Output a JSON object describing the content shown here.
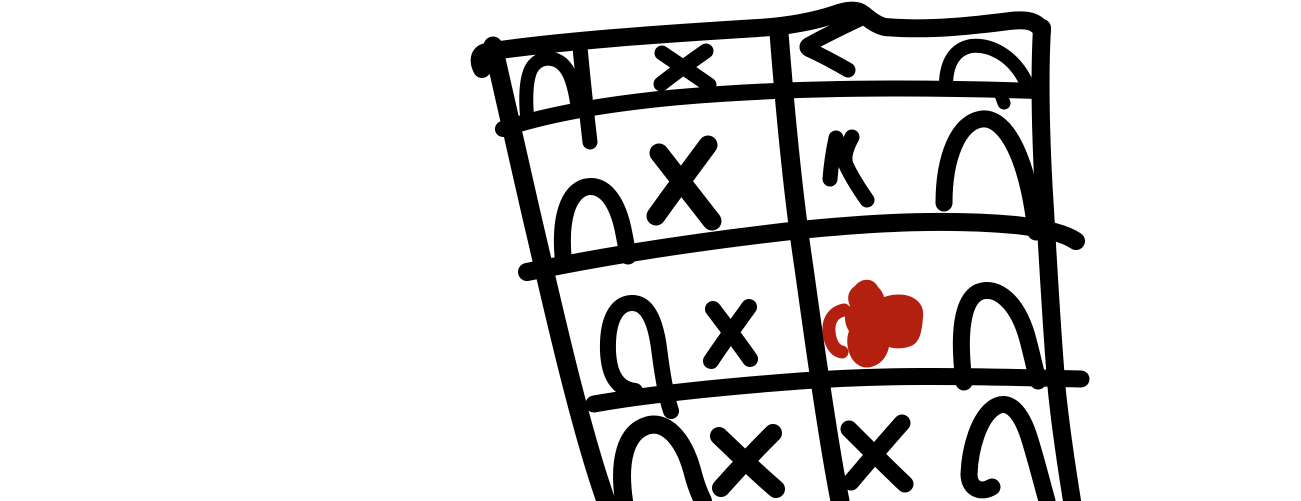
{
  "canvas": {
    "width": 1301,
    "height": 501,
    "background_color": "#ffffff",
    "ink_color": "#000000",
    "accent_color": "#b3200f",
    "description": "Freehand thick-marker doodle of a tilted grid table (4 visible rows x 2 columns, bottom row cut off by image edge) drawn in the right half of an otherwise blank white page. Cells contain arch (n-shaped) marks and X marks; one right-column cell holds a solid red scribble."
  },
  "grid": {
    "rows": 4,
    "columns": 2,
    "cells": [
      {
        "row": 1,
        "col": 1,
        "symbols": [
          "arch",
          "divider-tick",
          "x-mark"
        ]
      },
      {
        "row": 1,
        "col": 2,
        "symbols": [
          "hook-mark",
          "arch"
        ]
      },
      {
        "row": 2,
        "col": 1,
        "symbols": [
          "arch",
          "x-mark"
        ]
      },
      {
        "row": 2,
        "col": 2,
        "symbols": [
          "small-bent-mark",
          "arch"
        ]
      },
      {
        "row": 3,
        "col": 1,
        "symbols": [
          "arch",
          "x-mark"
        ]
      },
      {
        "row": 3,
        "col": 2,
        "symbols": [
          "red-scribble",
          "arch"
        ]
      },
      {
        "row": 4,
        "col": 1,
        "symbols": [
          "arch",
          "x-mark"
        ]
      },
      {
        "row": 4,
        "col": 2,
        "symbols": [
          "x-mark",
          "arch"
        ]
      }
    ]
  },
  "drawing": {
    "paths": [
      {
        "name": "grid-top-edge",
        "d": "M 482 69 C 478 61 479 54 486 52 C 560 41 660 34 758 28 C 790 26 815 21 836 14 C 847 10 857 9 863 14 C 869 19 876 25 885 27 C 930 31 978 25 1010 21 C 1027 19 1037 21 1042 31",
        "w": 18
      },
      {
        "name": "grid-row-line-2",
        "d": "M 503 129 C 560 110 640 99 720 94 C 810 88 920 87 1036 91",
        "w": 16
      },
      {
        "name": "grid-row-line-3",
        "d": "M 527 272 C 610 255 700 241 800 230 C 880 222 950 219 1015 225 C 1042 228 1064 233 1076 241",
        "w": 18
      },
      {
        "name": "grid-row-line-4",
        "d": "M 594 404 C 650 394 720 387 800 381 C 880 375 960 376 1040 378 L 1081 379",
        "w": 17
      },
      {
        "name": "grid-left-edge",
        "d": "M 493 46 C 506 105 522 175 538 243 C 552 303 580 428 606 501",
        "w": 19
      },
      {
        "name": "grid-middle-divider",
        "d": "M 779 33 C 785 110 793 195 804 268 C 814 340 828 440 840 501",
        "w": 19
      },
      {
        "name": "grid-right-edge",
        "d": "M 1042 28 C 1039 80 1041 150 1045 210 C 1048 262 1052 335 1057 392 C 1062 440 1068 475 1072 501",
        "w": 18
      },
      {
        "name": "header-cell-divider-tick",
        "d": "M 580 47 C 583 80 587 116 590 142",
        "w": 15
      },
      {
        "name": "r1c1-arch",
        "d": "M 527 116 C 525 91 527 71 535 64 C 543 56 557 57 565 67 C 572 75 576 93 578 110",
        "w": 14
      },
      {
        "name": "r1c1-x-stroke-1",
        "d": "M 661 84 C 676 72 692 61 706 51",
        "w": 15
      },
      {
        "name": "r1c1-x-stroke-2",
        "d": "M 662 53 C 678 64 695 75 709 85",
        "w": 15
      },
      {
        "name": "r1c2-hook-mark",
        "d": "M 864 17 C 845 26 826 35 810 44 C 806 46 806 48 810 50 C 823 56 836 63 848 70",
        "w": 15
      },
      {
        "name": "r1c2-arch",
        "d": "M 946 82 C 947 62 955 49 971 46 C 990 44 1012 55 1025 80",
        "w": 14
      },
      {
        "name": "r1c2-nub",
        "d": "M 1001 95 L 1004 103",
        "w": 13
      },
      {
        "name": "r2c1-arch",
        "d": "M 563 256 C 560 218 568 192 586 187 C 604 183 618 201 624 234 C 626 244 627 250 628 256",
        "w": 17
      },
      {
        "name": "r2c1-x-stroke-1",
        "d": "M 656 216 C 673 192 691 168 708 145",
        "w": 19
      },
      {
        "name": "r2c1-x-stroke-2",
        "d": "M 659 153 C 677 176 695 199 712 221",
        "w": 19
      },
      {
        "name": "r2c2-bent-mark-stroke-1",
        "d": "M 836 138 C 833 152 831 166 830 179",
        "w": 15
      },
      {
        "name": "r2c2-bent-mark-stroke-2",
        "d": "M 852 137 C 846 148 843 157 846 165 C 852 178 860 190 867 200",
        "w": 15
      },
      {
        "name": "r2c2-arch",
        "d": "M 944 203 C 944 158 958 122 982 119 C 1007 117 1028 160 1036 232",
        "w": 17
      },
      {
        "name": "r3c1-arch",
        "d": "M 635 391 C 618 389 609 376 608 351 C 607 319 617 304 631 303 C 646 302 655 318 659 348 C 662 372 666 396 671 411",
        "w": 16
      },
      {
        "name": "r3c1-x-stroke-1",
        "d": "M 713 309 C 726 326 739 343 750 359",
        "w": 16
      },
      {
        "name": "r3c1-x-stroke-2",
        "d": "M 749 307 C 736 325 723 343 711 361",
        "w": 16
      },
      {
        "name": "r3c2-arch",
        "d": "M 964 382 C 958 334 962 300 979 292 C 997 285 1018 302 1028 340 C 1032 355 1035 369 1038 381",
        "w": 17
      },
      {
        "name": "r4c1-arch",
        "d": "M 624 501 C 618 460 626 433 646 426 C 665 419 683 438 692 470 C 695 482 699 493 703 501",
        "w": 18
      },
      {
        "name": "r4c1-x-stroke-1",
        "d": "M 721 488 C 738 469 756 450 773 433",
        "w": 18
      },
      {
        "name": "r4c1-x-stroke-2",
        "d": "M 719 436 C 738 454 757 473 776 489",
        "w": 18
      },
      {
        "name": "r4c2-x-stroke-1",
        "d": "M 851 482 C 868 462 885 442 902 423",
        "w": 17
      },
      {
        "name": "r4c2-x-stroke-2",
        "d": "M 849 429 C 867 447 886 466 905 484",
        "w": 17
      },
      {
        "name": "r4c2-arch",
        "d": "M 992 487 C 980 494 969 488 969 474 C 970 448 979 417 995 407 C 1008 399 1021 410 1030 440 C 1037 463 1042 483 1047 501",
        "w": 17
      },
      {
        "name": "red-scribble-body",
        "d": "M 855 286 C 861 278 873 277 878 287 C 881 290 883 293 884 297 C 896 293 908 294 915 299 C 921 303 924 309 923 317 C 922 333 919 343 911 346 C 903 349 895 349 889 347 C 887 356 882 363 874 366 C 865 370 856 366 851 357 C 847 349 846 339 849 331 C 844 324 843 312 850 306 C 846 297 849 290 855 286 Z",
        "fill": true,
        "color": "#b3200f"
      },
      {
        "name": "red-scribble-tail",
        "d": "M 844 310 C 834 312 828 320 829 332 C 830 343 835 351 842 352",
        "w": 13,
        "color": "#b3200f"
      }
    ]
  }
}
